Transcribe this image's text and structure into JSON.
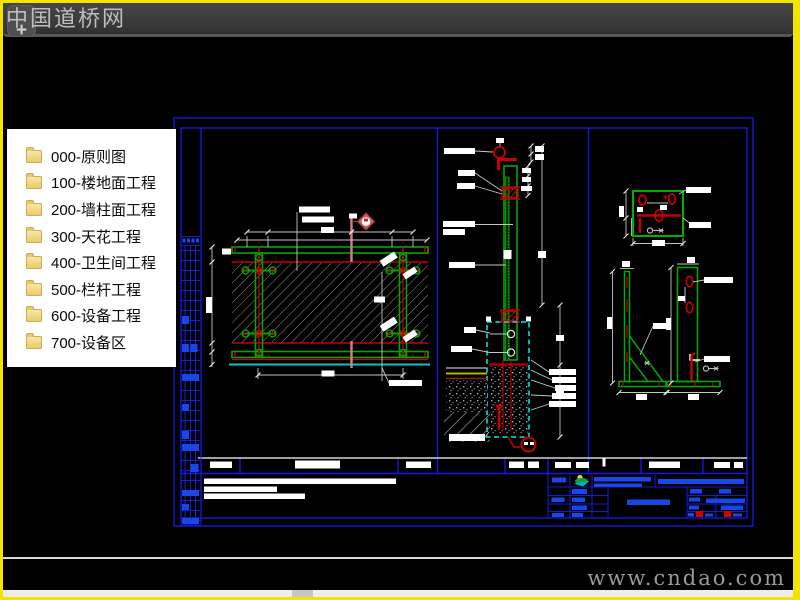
{
  "titlebar": {
    "watermark_text": "中国道桥网",
    "logo_plus": "+"
  },
  "footer": {
    "watermark_text": "www.cndao.com"
  },
  "sidebar": {
    "items": [
      {
        "label": "000-原则图"
      },
      {
        "label": "100-楼地面工程"
      },
      {
        "label": "200-墙柱面工程"
      },
      {
        "label": "300-天花工程"
      },
      {
        "label": "400-卫生间工程"
      },
      {
        "label": "500-栏杆工程"
      },
      {
        "label": "600-设备工程"
      },
      {
        "label": "700-设备区"
      }
    ]
  },
  "colors": {
    "frame_blue": "#1616dc",
    "fill_blue": "#1847e8",
    "cad_green": "#00a800",
    "cad_red": "#c80000",
    "cad_cyan": "#00c8c8",
    "section_salmon": "#d78080",
    "border_yellow": "#f0e400",
    "folder_yellow": "#eccb6d"
  }
}
